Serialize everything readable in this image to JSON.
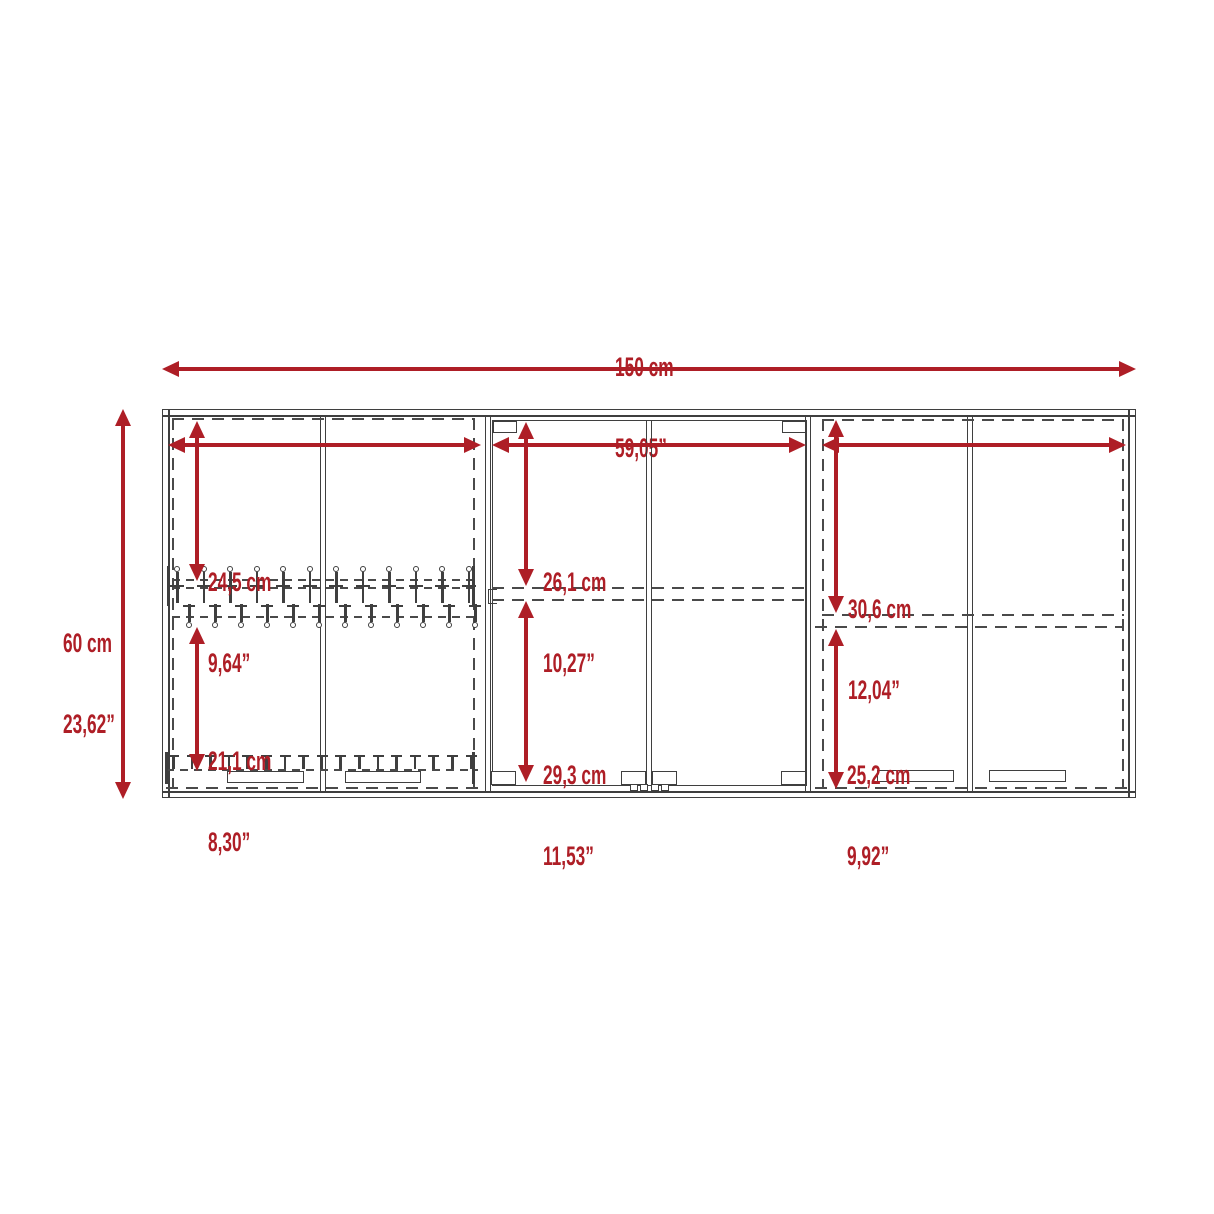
{
  "diagram_title": "wall-cabinet-dimension-diagram",
  "colors": {
    "dimension_red": "#ae1e26",
    "line_gray": "#3f3f3f",
    "background": "#ffffff"
  },
  "overall": {
    "width": {
      "cm": "150 cm",
      "in": "59,05”"
    },
    "height": {
      "cm": "60 cm",
      "in": "23,62”"
    }
  },
  "sections": [
    {
      "id": "left",
      "top": {
        "cm": "24,5 cm",
        "in": "9,64”"
      },
      "bottom": {
        "cm": "21,1 cm",
        "in": "8,30”"
      }
    },
    {
      "id": "middle",
      "top": {
        "cm": "26,1 cm",
        "in": "10,27”"
      },
      "bottom": {
        "cm": "29,3 cm",
        "in": "11,53”"
      }
    },
    {
      "id": "right",
      "top": {
        "cm": "30,6 cm",
        "in": "12,04”"
      },
      "bottom": {
        "cm": "25,2 cm",
        "in": "9,92”"
      }
    }
  ],
  "hardware": {
    "upper_hooks": 12,
    "lower_hooks": 12,
    "bottom_hooks": 17
  }
}
